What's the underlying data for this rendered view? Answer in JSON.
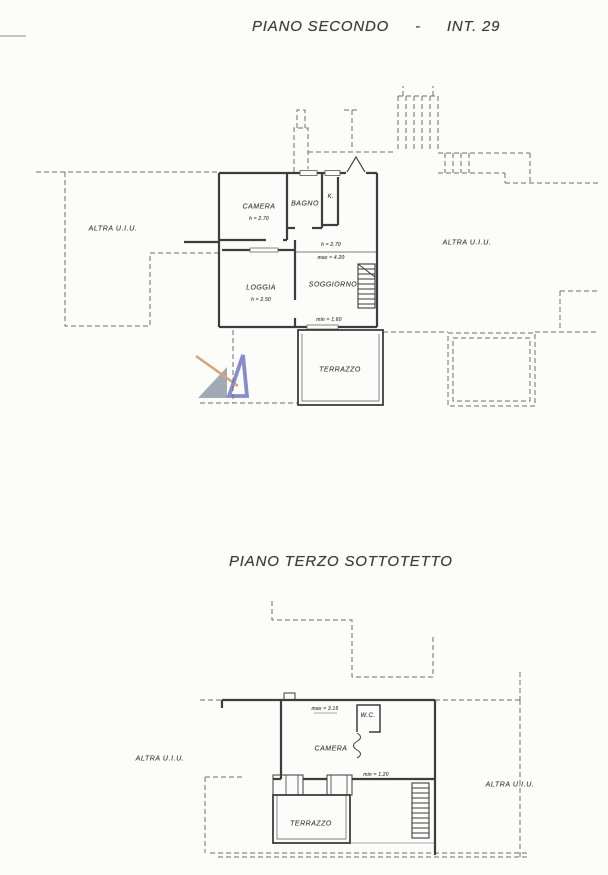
{
  "plan_second": {
    "title_name": "PIANO SECONDO",
    "title_sep": "-",
    "title_int": "INT. 29",
    "camera_label": "CAMERA",
    "camera_height": "h = 2.70",
    "bagno_label": "BAGNO",
    "k_label": "K.",
    "h_annotation": "h = 2.70",
    "max_annotation": "max = 4.20",
    "loggia_label": "LOGGIA",
    "loggia_height": "h = 2.50",
    "soggiorno_label": "SOGGIORNO",
    "min_annotation": "min = 1.60",
    "terrazzo_label": "TERRAZZO",
    "altra_left": "ALTRA U.I.U.",
    "altra_right": "ALTRA U.I.U."
  },
  "plan_attic": {
    "title": "PIANO TERZO SOTTOTETTO",
    "max_annotation": "max = 3.15",
    "wc_label": "W.C.",
    "camera_label": "CAMERA",
    "min_annotation": "min = 1.20",
    "terrazzo_label": "TERRAZZO",
    "altra_left": "ALTRA U.I.U.",
    "altra_right": "ALTRA U.I.U."
  },
  "watermark": {
    "blue": "#7b85c5",
    "gray": "#9aa2ac",
    "orange": "#d79d6e"
  }
}
